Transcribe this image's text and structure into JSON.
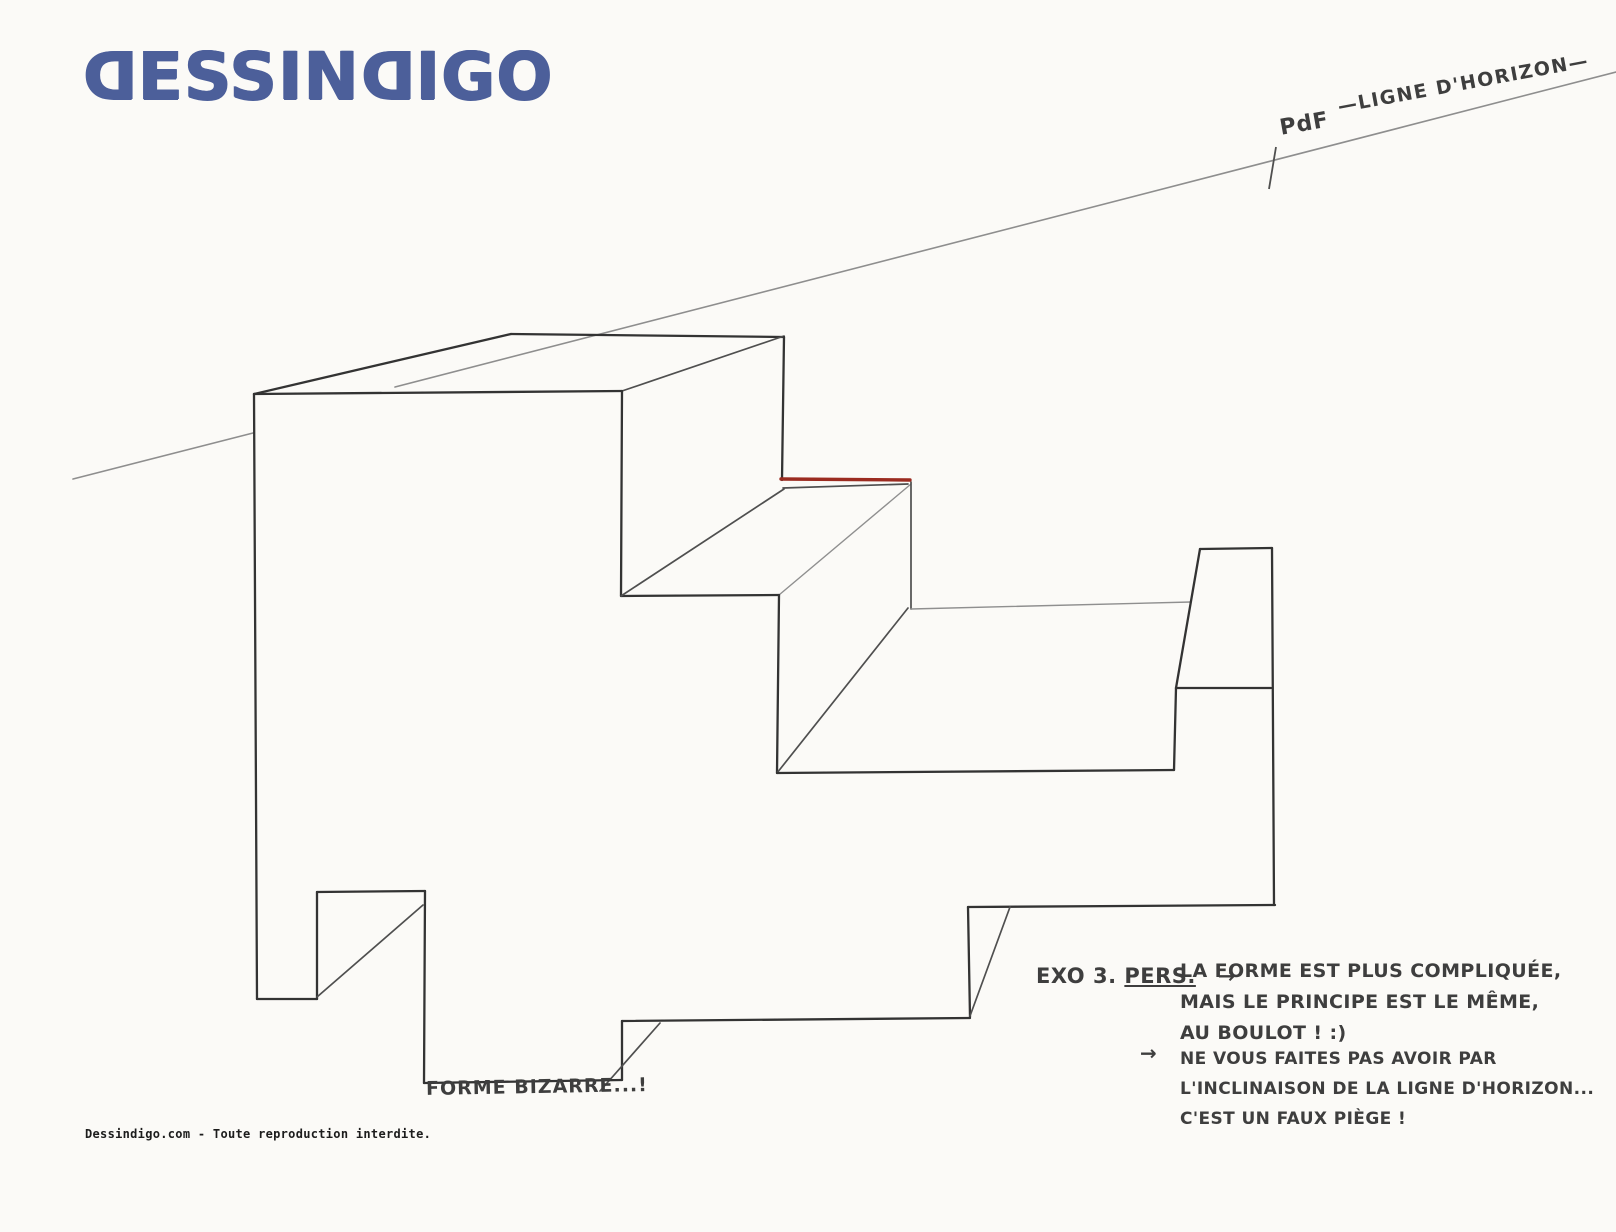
{
  "logo": {
    "text": "DESSINDIGO",
    "color": "#4c5f9a",
    "mirrored_letter": "D"
  },
  "colors": {
    "paper": "#fbfaf7",
    "ink": "#3e3e3e",
    "pencil_heavy": "#333333",
    "pencil_medium": "#4f4f4f",
    "pencil_faint": "#8f8f8f",
    "horizon_gray": "#8e8e8e",
    "red_edge": "#9b2b20"
  },
  "horizon": {
    "label": "—LIGNE D'HORIZON—",
    "vanishing_point_label": "PdF",
    "segments": [
      {
        "x1": 73,
        "y1": 479,
        "x2": 253,
        "y2": 433
      },
      {
        "x1": 395,
        "y1": 387,
        "x2": 1616,
        "y2": 72
      }
    ],
    "tick": {
      "x1": 1276,
      "y1": 147,
      "x2": 1269,
      "y2": 189
    }
  },
  "drawing": {
    "caption": "FORME BIZARRE...!",
    "silhouette": "254,394 622,391 784,336 782,480 911,481 911,609 1191,602 1200,549 1272,548 1274,905 968,907 970,1017 622,1021 622,1080 424,1083 425,891 317,892 317,999 257,999",
    "segments": [
      {
        "x1": 254,
        "y1": 394,
        "x2": 622,
        "y2": 391,
        "cls": "heavy"
      },
      {
        "x1": 254,
        "y1": 394,
        "x2": 511,
        "y2": 334,
        "cls": "heavy"
      },
      {
        "x1": 511,
        "y1": 334,
        "x2": 784,
        "y2": 337,
        "cls": "heavy"
      },
      {
        "x1": 622,
        "y1": 391,
        "x2": 784,
        "y2": 336,
        "cls": "medium"
      },
      {
        "x1": 784,
        "y1": 337,
        "x2": 782,
        "y2": 480,
        "cls": "heavy"
      },
      {
        "x1": 622,
        "y1": 391,
        "x2": 621,
        "y2": 596,
        "cls": "heavy"
      },
      {
        "x1": 621,
        "y1": 596,
        "x2": 779,
        "y2": 595,
        "cls": "heavy"
      },
      {
        "x1": 621,
        "y1": 596,
        "x2": 784,
        "y2": 489,
        "cls": "medium"
      },
      {
        "x1": 783,
        "y1": 488,
        "x2": 908,
        "y2": 484,
        "cls": "medium"
      },
      {
        "x1": 779,
        "y1": 595,
        "x2": 911,
        "y2": 484,
        "cls": "faint"
      },
      {
        "x1": 911,
        "y1": 482,
        "x2": 911,
        "y2": 609,
        "cls": "medium"
      },
      {
        "x1": 779,
        "y1": 595,
        "x2": 777,
        "y2": 773,
        "cls": "heavy"
      },
      {
        "x1": 777,
        "y1": 773,
        "x2": 908,
        "y2": 608,
        "cls": "medium"
      },
      {
        "x1": 911,
        "y1": 609,
        "x2": 1191,
        "y2": 602,
        "cls": "faint"
      },
      {
        "x1": 777,
        "y1": 773,
        "x2": 1174,
        "y2": 770,
        "cls": "heavy"
      },
      {
        "x1": 1174,
        "y1": 770,
        "x2": 1176,
        "y2": 688,
        "cls": "heavy"
      },
      {
        "x1": 1176,
        "y1": 688,
        "x2": 1271,
        "y2": 688,
        "cls": "heavy"
      },
      {
        "x1": 1176,
        "y1": 688,
        "x2": 1200,
        "y2": 549,
        "cls": "heavy"
      },
      {
        "x1": 1200,
        "y1": 549,
        "x2": 1272,
        "y2": 548,
        "cls": "heavy"
      },
      {
        "x1": 1272,
        "y1": 548,
        "x2": 1274,
        "y2": 905,
        "cls": "heavy"
      },
      {
        "x1": 1275,
        "y1": 905,
        "x2": 968,
        "y2": 907,
        "cls": "heavy"
      },
      {
        "x1": 968,
        "y1": 907,
        "x2": 970,
        "y2": 1017,
        "cls": "heavy"
      },
      {
        "x1": 970,
        "y1": 1016,
        "x2": 1010,
        "y2": 907,
        "cls": "medium"
      },
      {
        "x1": 970,
        "y1": 1018,
        "x2": 622,
        "y2": 1021,
        "cls": "heavy"
      },
      {
        "x1": 622,
        "y1": 1021,
        "x2": 622,
        "y2": 1080,
        "cls": "heavy"
      },
      {
        "x1": 600,
        "y1": 1091,
        "x2": 660,
        "y2": 1023,
        "cls": "medium"
      },
      {
        "x1": 622,
        "y1": 1080,
        "x2": 424,
        "y2": 1083,
        "cls": "heavy"
      },
      {
        "x1": 424,
        "y1": 1083,
        "x2": 425,
        "y2": 891,
        "cls": "heavy"
      },
      {
        "x1": 425,
        "y1": 891,
        "x2": 317,
        "y2": 892,
        "cls": "heavy"
      },
      {
        "x1": 317,
        "y1": 892,
        "x2": 317,
        "y2": 999,
        "cls": "heavy"
      },
      {
        "x1": 317,
        "y1": 999,
        "x2": 257,
        "y2": 999,
        "cls": "heavy"
      },
      {
        "x1": 317,
        "y1": 997,
        "x2": 423,
        "y2": 905,
        "cls": "medium"
      },
      {
        "x1": 257,
        "y1": 999,
        "x2": 254,
        "y2": 394,
        "cls": "heavy"
      }
    ],
    "red_edge": {
      "x1": 781,
      "y1": 479,
      "x2": 910,
      "y2": 480
    }
  },
  "notes": {
    "exercise_label": "EXO 3.",
    "exercise_mode": "PERS.",
    "arrow": "→",
    "lines_group1": [
      "LA FORME EST PLUS COMPLIQUÉE,",
      "MAIS LE PRINCIPE EST LE MÊME,",
      "AU BOULOT ! :)"
    ],
    "lines_group2": [
      "NE VOUS FAITES PAS AVOIR PAR",
      "L'INCLINAISON DE LA LIGNE D'HORIZON...",
      "C'EST UN FAUX PIÈGE !"
    ]
  },
  "footer": {
    "text": "Dessindigo.com - Toute reproduction interdite."
  }
}
